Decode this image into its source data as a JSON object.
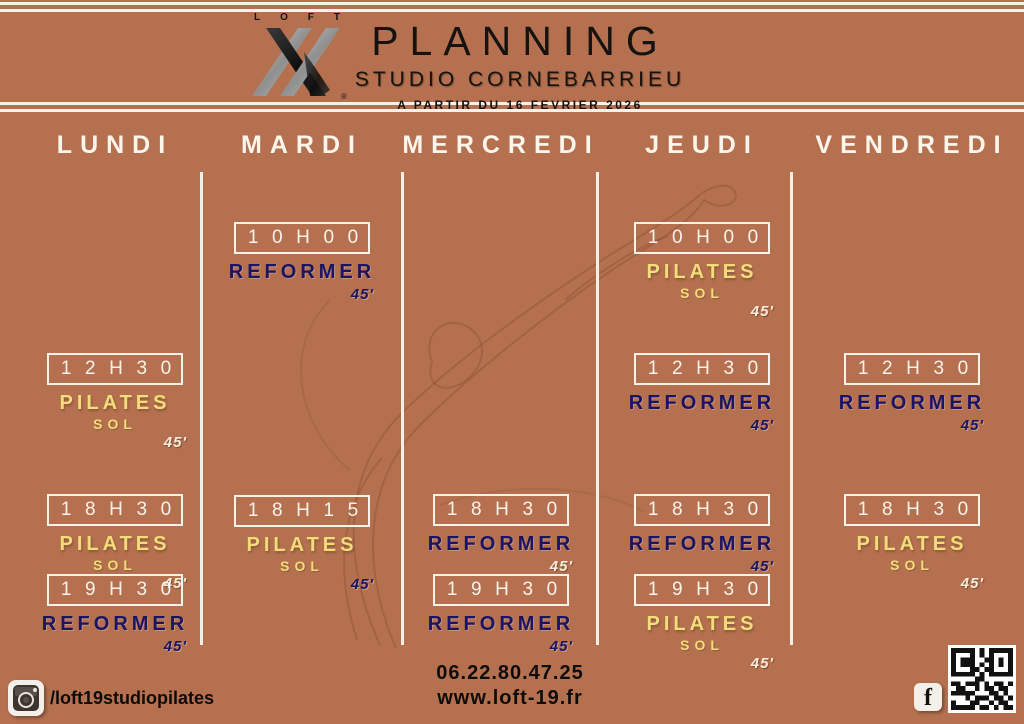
{
  "colors": {
    "background": "#b5714f",
    "navy": "#1b1464",
    "yellow": "#f2dd7a",
    "line_white": "#f7f1e9",
    "text_black": "#151210"
  },
  "header": {
    "logo_brand": "LOFT",
    "logo_registered": "®",
    "title": "PLANNING",
    "subtitle": "STUDIO CORNEBARRIEU",
    "effective_date": "A PARTIR DU 16 FEVRIER 2026"
  },
  "schedule": {
    "days": [
      "LUNDI",
      "MARDI",
      "MERCREDI",
      "JEUDI",
      "VENDREDI"
    ],
    "slots": [
      {
        "day": "LUNDI",
        "time": "12H30",
        "activity": "PILATES",
        "detail": "SOL",
        "activity_color": "yellow",
        "duration": "45'",
        "duration_color": "white"
      },
      {
        "day": "LUNDI",
        "time": "18H30",
        "activity": "PILATES",
        "detail": "SOL",
        "activity_color": "yellow",
        "duration": "45'",
        "duration_color": "white"
      },
      {
        "day": "LUNDI",
        "time": "19H30",
        "activity": "REFORMER",
        "detail": "",
        "activity_color": "navy",
        "duration": "45'",
        "duration_color": "navy"
      },
      {
        "day": "MARDI",
        "time": "10H00",
        "activity": "REFORMER",
        "detail": "",
        "activity_color": "navy",
        "duration": "45'",
        "duration_color": "navy"
      },
      {
        "day": "MARDI",
        "time": "18H15",
        "activity": "PILATES",
        "detail": "SOL",
        "activity_color": "yellow",
        "duration": "45'",
        "duration_color": "navy"
      },
      {
        "day": "MERCREDI",
        "time": "18H30",
        "activity": "REFORMER",
        "detail": "",
        "activity_color": "navy",
        "duration": "45'",
        "duration_color": "white"
      },
      {
        "day": "MERCREDI",
        "time": "19H30",
        "activity": "REFORMER",
        "detail": "",
        "activity_color": "navy",
        "duration": "45'",
        "duration_color": "navy"
      },
      {
        "day": "JEUDI",
        "time": "10H00",
        "activity": "PILATES",
        "detail": "SOL",
        "activity_color": "yellow",
        "duration": "45'",
        "duration_color": "white"
      },
      {
        "day": "JEUDI",
        "time": "12H30",
        "activity": "REFORMER",
        "detail": "",
        "activity_color": "navy",
        "duration": "45'",
        "duration_color": "navy"
      },
      {
        "day": "JEUDI",
        "time": "18H30",
        "activity": "REFORMER",
        "detail": "",
        "activity_color": "navy",
        "duration": "45'",
        "duration_color": "navy"
      },
      {
        "day": "JEUDI",
        "time": "19H30",
        "activity": "PILATES",
        "detail": "SOL",
        "activity_color": "yellow",
        "duration": "45'",
        "duration_color": "white"
      },
      {
        "day": "VENDREDI",
        "time": "12H30",
        "activity": "REFORMER",
        "detail": "",
        "activity_color": "navy",
        "duration": "45'",
        "duration_color": "navy"
      },
      {
        "day": "VENDREDI",
        "time": "18H30",
        "activity": "PILATES",
        "detail": "SOL",
        "activity_color": "yellow",
        "duration": "45'",
        "duration_color": "white"
      }
    ]
  },
  "footer": {
    "instagram_handle": "/loft19studiopilates",
    "phone": "06.22.80.47.25",
    "website": "www.loft-19.fr",
    "icons": {
      "instagram": "instagram-icon",
      "facebook": "facebook-icon",
      "qr": "qr-code"
    }
  }
}
